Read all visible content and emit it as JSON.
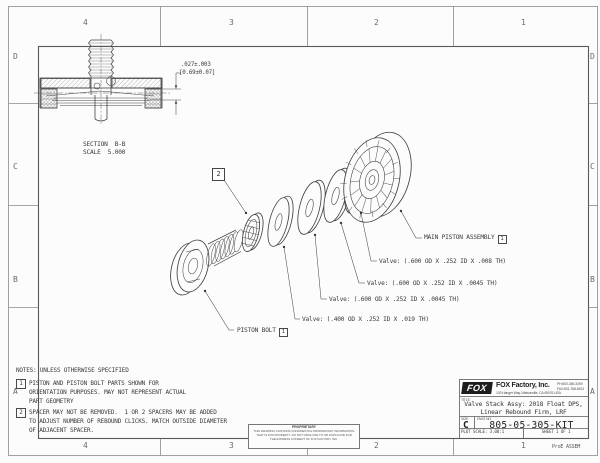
{
  "frame": {
    "zones_top": [
      "4",
      "3",
      "2",
      "1"
    ],
    "zones_bottom": [
      "4",
      "3",
      "2",
      "1"
    ],
    "zones_left": [
      "D",
      "C",
      "B",
      "A"
    ],
    "zones_right": [
      "D",
      "C",
      "B",
      "A"
    ],
    "plot_tag": "ProE ASSEM"
  },
  "section_view": {
    "dim_in": ".027±.003",
    "dim_mm": "[0.69±0.07]",
    "name": "SECTION  B-B",
    "scale": "SCALE  5.000"
  },
  "exploded": {
    "balloon": "2",
    "main_piston_label": "MAIN PISTON ASSEMBLY",
    "main_piston_flag": "1",
    "valve_008": "Valve: (.600 OD X .252 ID X .008 TH)",
    "valve_0045a": "Valve: (.600 OD X .252 ID X .0045 TH)",
    "valve_0045b": "Valve: (.600 OD X .252 ID X .0045 TH)",
    "valve_019": "Valve: (.400 OD X .252 ID X .019 TH)",
    "piston_bolt_label": "PISTON BOLT",
    "piston_bolt_flag": "1"
  },
  "notes": {
    "header": "NOTES: UNLESS OTHERWISE SPECIFIED",
    "items": [
      {
        "num": "1",
        "l1": "PISTON AND PISTON BOLT PARTS SHOWN FOR",
        "l2": "ORIENTATION PURPOSES. MAY NOT REPRESENT ACTUAL",
        "l3": "PART GEOMETRY"
      },
      {
        "num": "2",
        "l1": "SPACER MAY NOT BE REMOVED.  1 OR 2 SPACERS MAY BE ADDED",
        "l2": "TO ADJUST NUMBER OF REBOUND CLICKS. MATCH OUTSIDE DIAMETER",
        "l3": "OF ADJACENT SPACER."
      }
    ]
  },
  "title_block": {
    "logo": "FOX",
    "company": "FOX Factory, Inc.",
    "address": "130 Hanger Way, Watsonville, CA 95076 USA",
    "phone": "PH:800-369-3399",
    "fax": "FAX:831-768-6613",
    "title_label": "TITLE",
    "title_line1": "Valve Stack Assy: 2018 Float DPS,",
    "title_line2": "Linear Rebound Firm, LRF",
    "size_label": "SIZE",
    "size": "C",
    "dwg_label": "DWG NO.",
    "dwg_no": "805-05-305-KIT",
    "plot_scale": "PLOT SCALE: 3.00:1",
    "sheet": "SHEET 1 OF 1"
  },
  "proprietary": {
    "heading": "PROPRIETARY",
    "line1": "THIS DRAWING CONTAINS CONFIDENTIAL PROPRIETARY INFORMATION",
    "line2": "THAT IS FOX PROPERTY.  DO NOT DISCLOSE TO OR DUPLICATE FOR",
    "line3": "THE EXPRESS CONSENT OF FOX FACTORY, INC."
  },
  "colors": {
    "line": "#4a4a4a",
    "text": "#3a3a3a",
    "paper": "#fcfcfc"
  }
}
